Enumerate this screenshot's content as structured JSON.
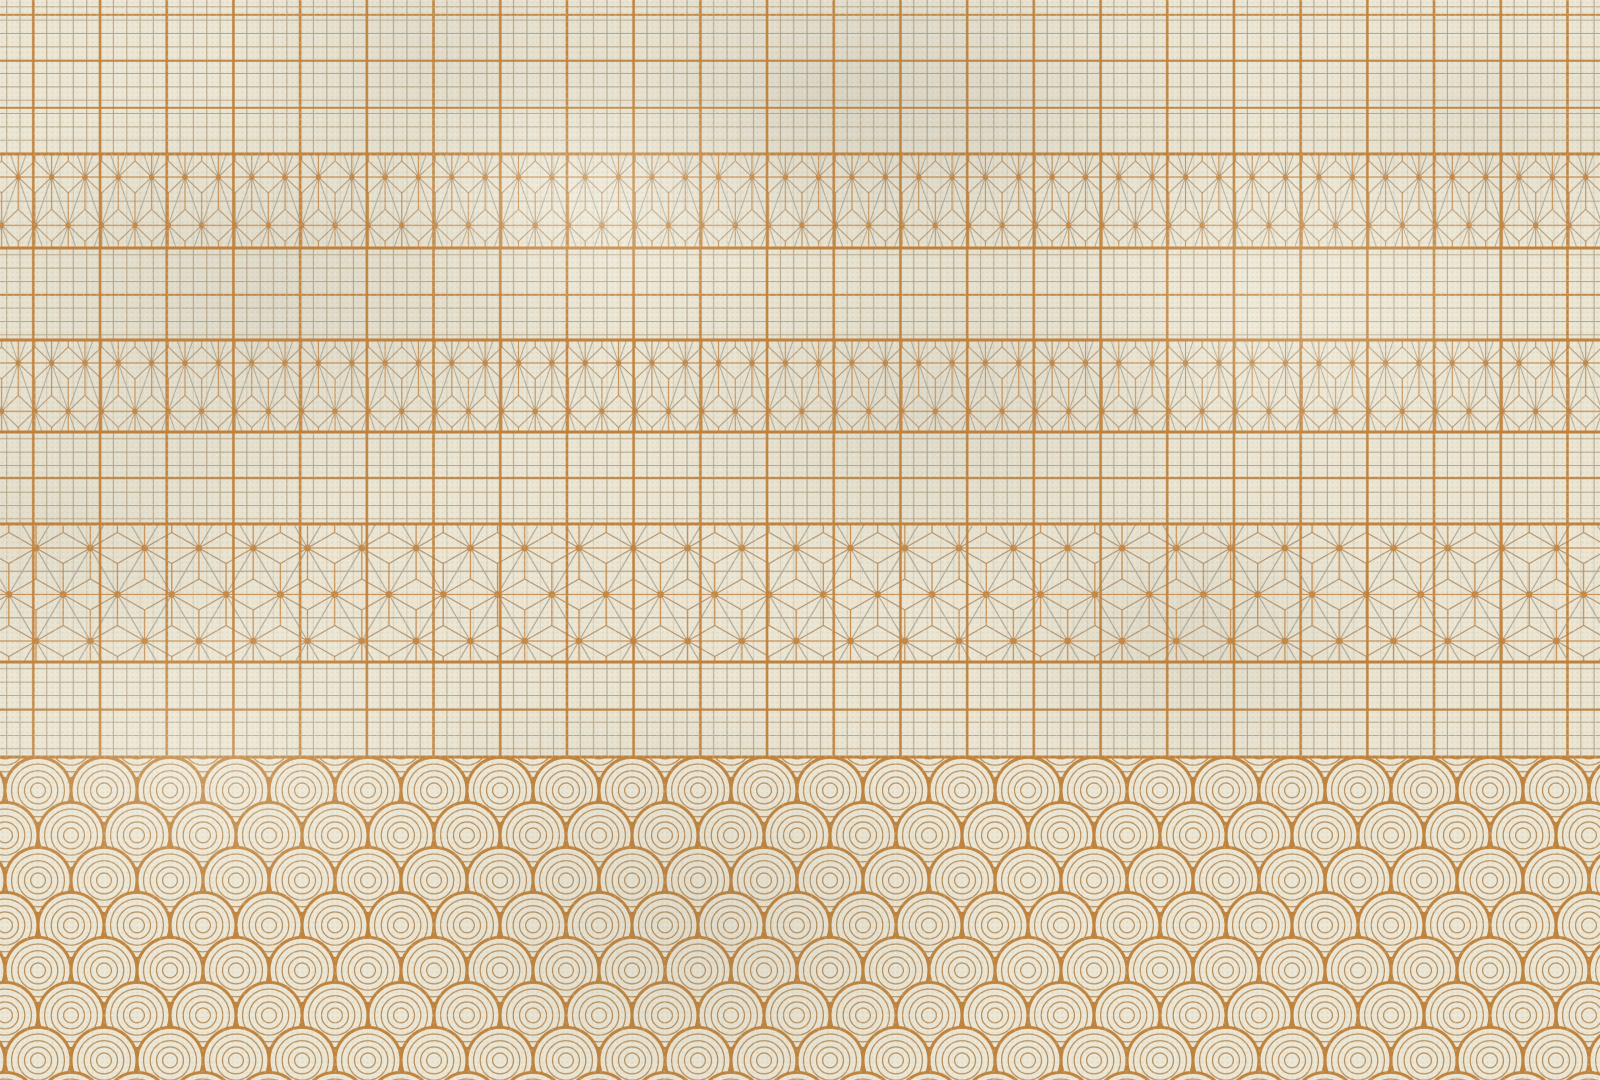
{
  "artwork": {
    "kind": "japanese-washi-pattern-collage",
    "width": 1600,
    "height": 1080,
    "pattern_extent_without_waves": 757
  },
  "palette": {
    "paper": "#ece6d4",
    "paper_light": "#f4f0e3",
    "orange_thick": "#c0823c",
    "orange_line": "#c68c4e",
    "tan_line": "#b39470",
    "grey_line": "#a7a08d",
    "fine_grid": "#b2a184",
    "wave_outer": "#c0843e",
    "wave_inner": "#b9905e",
    "dot": "#c78844"
  },
  "overlays": {
    "thick_vertical_lines": {
      "spacing": 66.7,
      "phase": 33.35,
      "stroke": 2.6,
      "extent": 757,
      "opacity": 0.95
    },
    "fine_vertical_lines": {
      "spacing": 13.34,
      "phase": 6.67,
      "stroke": 0.9,
      "extent": 757,
      "opacity": 0.38
    }
  },
  "bands": [
    {
      "type": "grid",
      "name": "koushi-grid-band-1",
      "top": 0,
      "height": 154,
      "cell": 13.34,
      "group": 66.7,
      "ty": 6.3
    },
    {
      "type": "asanoha",
      "name": "asanoha-small-band-1",
      "top": 154,
      "height": 94,
      "a": 33.35,
      "b": 48.3,
      "tx": 18.25,
      "ty": 23,
      "stroke": 1.05,
      "dot": 2.8
    },
    {
      "type": "grid",
      "name": "koushi-grid-band-2",
      "top": 248,
      "height": 92,
      "cell": 13.34,
      "group": 66.7,
      "ty": 6.3
    },
    {
      "type": "asanoha",
      "name": "asanoha-small-band-2",
      "top": 340,
      "height": 92,
      "a": 33.35,
      "b": 48.3,
      "tx": 18.25,
      "ty": 23,
      "stroke": 1.05,
      "dot": 2.8
    },
    {
      "type": "grid",
      "name": "koushi-grid-band-3",
      "top": 432,
      "height": 92,
      "cell": 13.34,
      "group": 66.7,
      "ty": 6.3
    },
    {
      "type": "asanoha",
      "name": "asanoha-large-band",
      "top": 524,
      "height": 138,
      "a": 54.3,
      "b": 46.5,
      "tx": 36,
      "ty": 24,
      "stroke": 1.2,
      "dot": 3.4
    },
    {
      "type": "grid",
      "name": "koushi-grid-band-4",
      "top": 662,
      "height": 95,
      "cell": 13.34,
      "group": 66.7,
      "ty": 6.3
    },
    {
      "type": "seigaiha",
      "name": "seigaiha-wave-band",
      "top": 757,
      "height": 323,
      "unit": 66,
      "row_height": 45,
      "radii": [
        33,
        26.4,
        19.8,
        13.5,
        7.4
      ],
      "tx": 21.5,
      "ty": 33.4,
      "outer_stroke": 3.1,
      "inner_stroke": 1.25
    }
  ],
  "dividers": {
    "major": {
      "ys": [
        154,
        248,
        340,
        432,
        524,
        662,
        757
      ],
      "stroke": 3
    },
    "minor": {
      "ys": [
        15,
        61,
        107.5,
        295,
        478,
        709.5
      ],
      "stroke": 2.4
    }
  }
}
